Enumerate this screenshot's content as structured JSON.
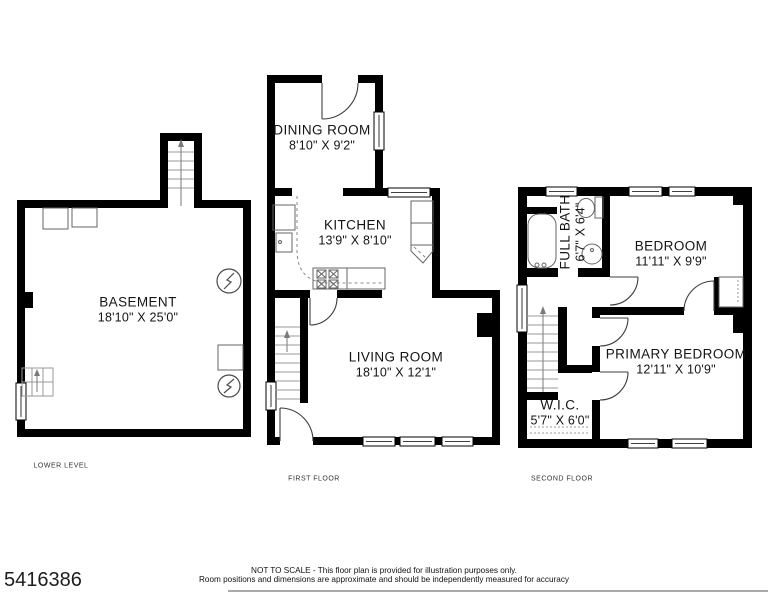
{
  "photo_id": "5416386",
  "floors": {
    "lower": {
      "label": "LOWER LEVEL",
      "rooms": {
        "basement": {
          "name": "BASEMENT",
          "dims": "18'10\" X 25'0\""
        }
      }
    },
    "first": {
      "label": "FIRST FLOOR",
      "rooms": {
        "dining": {
          "name": "DINING ROOM",
          "dims": "8'10\" X 9'2\""
        },
        "kitchen": {
          "name": "KITCHEN",
          "dims": "13'9\" X 8'10\""
        },
        "living": {
          "name": "LIVING ROOM",
          "dims": "18'10\" X 12'1\""
        }
      }
    },
    "second": {
      "label": "SECOND FLOOR",
      "rooms": {
        "full_bath": {
          "name": "FULL BATH",
          "dims": "6'7\" X 6'4\""
        },
        "bedroom": {
          "name": "BEDROOM",
          "dims": "11'11\" X 9'9\""
        },
        "primary_bedroom": {
          "name": "PRIMARY BEDROOM",
          "dims": "12'11\" X 10'9\""
        },
        "wic": {
          "name": "W.I.C.",
          "dims": "5'7\" X 6'0\""
        }
      }
    }
  },
  "disclaimer": {
    "line1": "NOT TO SCALE - This floor plan is provided for illustration purposes only.",
    "line2": "Room positions and dimensions are approximate and should be independently measured for accuracy"
  },
  "icons": {
    "stair_direction": "up-arrow",
    "electrical_symbol": "lightning-bolt-in-circle"
  },
  "colors": {
    "walls": "#000000",
    "background": "#ffffff",
    "fixture_lines": "#646464"
  }
}
